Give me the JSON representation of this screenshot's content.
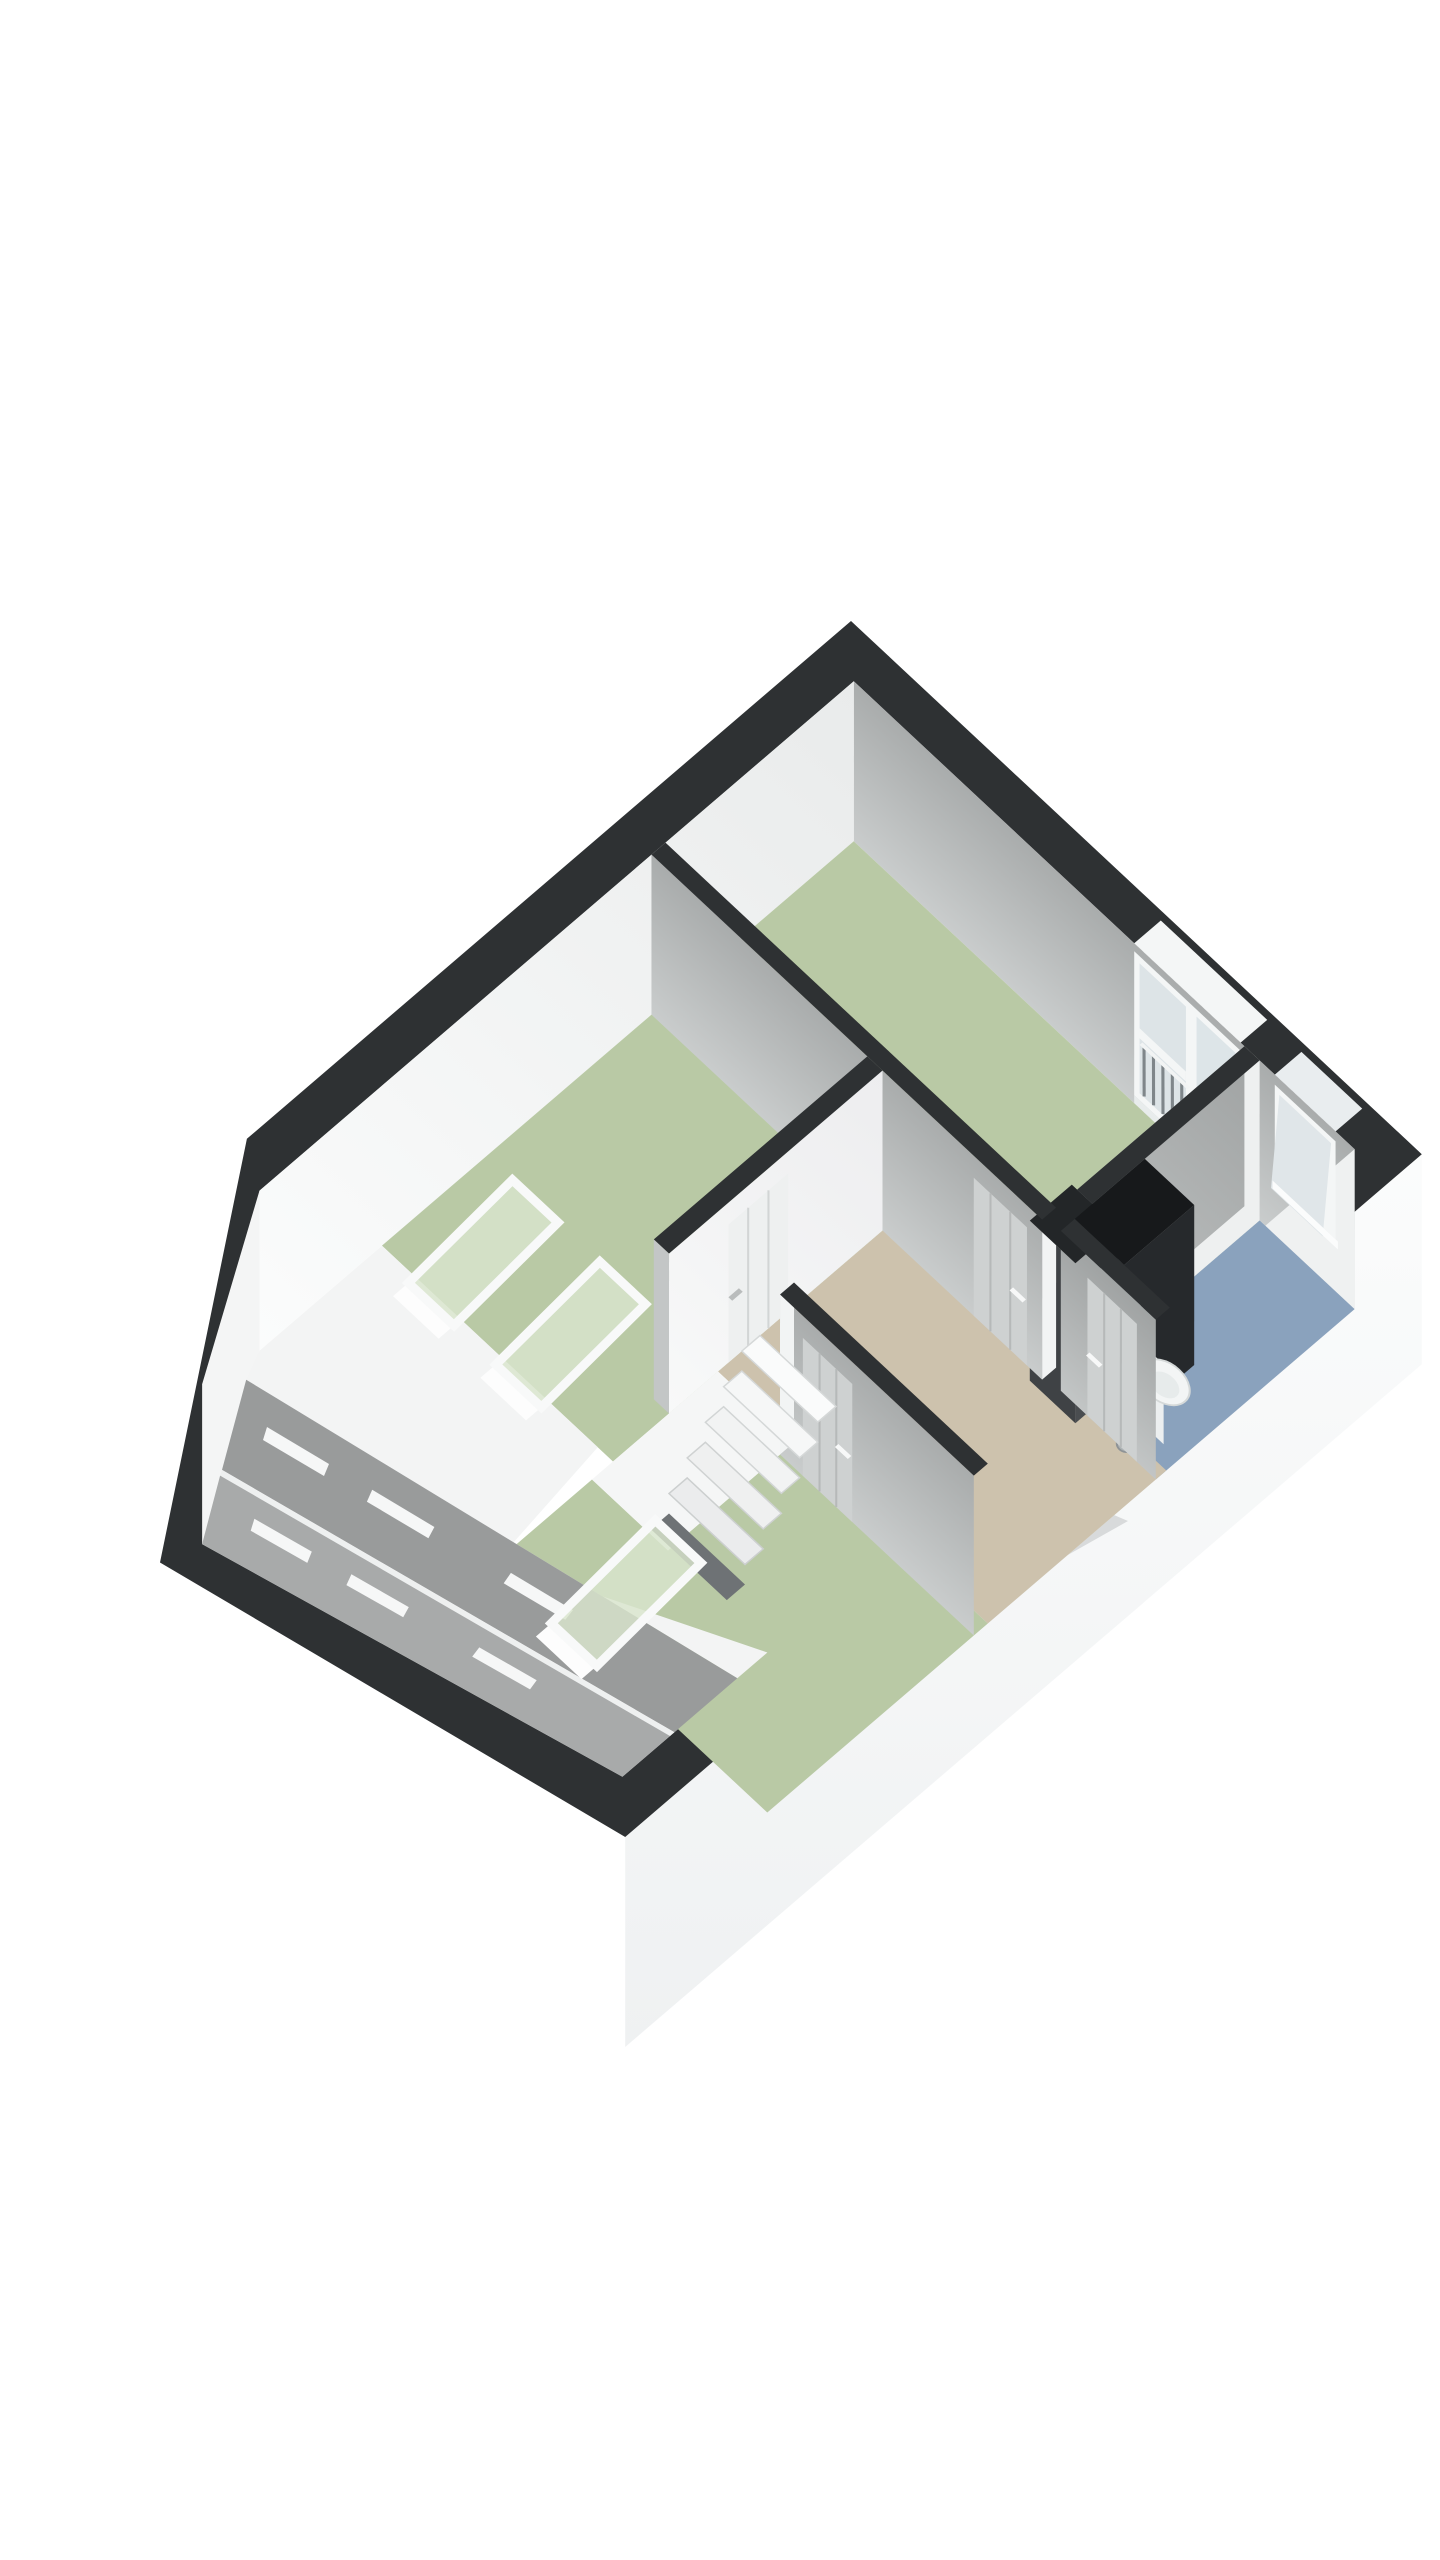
{
  "app": {
    "name": "3d-floor-plan-render",
    "background": "#ffffff",
    "visible_text": "none"
  },
  "palette": {
    "wall_top": "#2e3133",
    "wall_face_white": "#f2f3f3",
    "wall_face_gray": "#c0c3c3",
    "floor_green": "#b9c9a5",
    "floor_blue": "#8aa2bd",
    "floor_beige": "#cdc2ad",
    "slope_upper_strip": "#999b9b",
    "slope_lower_strip": "#a8aaaa",
    "knee_wall_band": "#f3f4f4",
    "exterior_wall": "#fafbfb",
    "cabinet_dark": "#26292c",
    "fixture_white": "#f3f5f5",
    "glass": "#dde4e7",
    "railing": "#7f868a",
    "skylight_glass": "#d9e5cd",
    "door_gray": "#ced1d1",
    "door_white": "#eef0f0",
    "stair_tread": "#fafbfb",
    "stair_void": "#6e7275",
    "drain": "#aeb3b5"
  },
  "floorplan": {
    "view": "axonometric 3d render rotated about 44 degrees",
    "rooms": [
      {
        "name": "bedroom-top",
        "floor": "green"
      },
      {
        "name": "bedroom-left",
        "floor": "green"
      },
      {
        "name": "bedroom-bottom",
        "floor": "green"
      },
      {
        "name": "bathroom",
        "floor": "blue",
        "fixtures": [
          "dark-cabinet",
          "sink",
          "toilet",
          "floor-drain"
        ]
      },
      {
        "name": "landing",
        "floor": "beige",
        "fixtures": [
          "staircase"
        ]
      }
    ],
    "openings": {
      "balcony_door_with_railing": 1,
      "bathroom_window": 1,
      "skylights": 3,
      "interior_doors_with_handles": 4
    },
    "roof": {
      "sloped_side": "lower-left",
      "gray_strips": 2,
      "white_sill_dashes": 6
    }
  }
}
